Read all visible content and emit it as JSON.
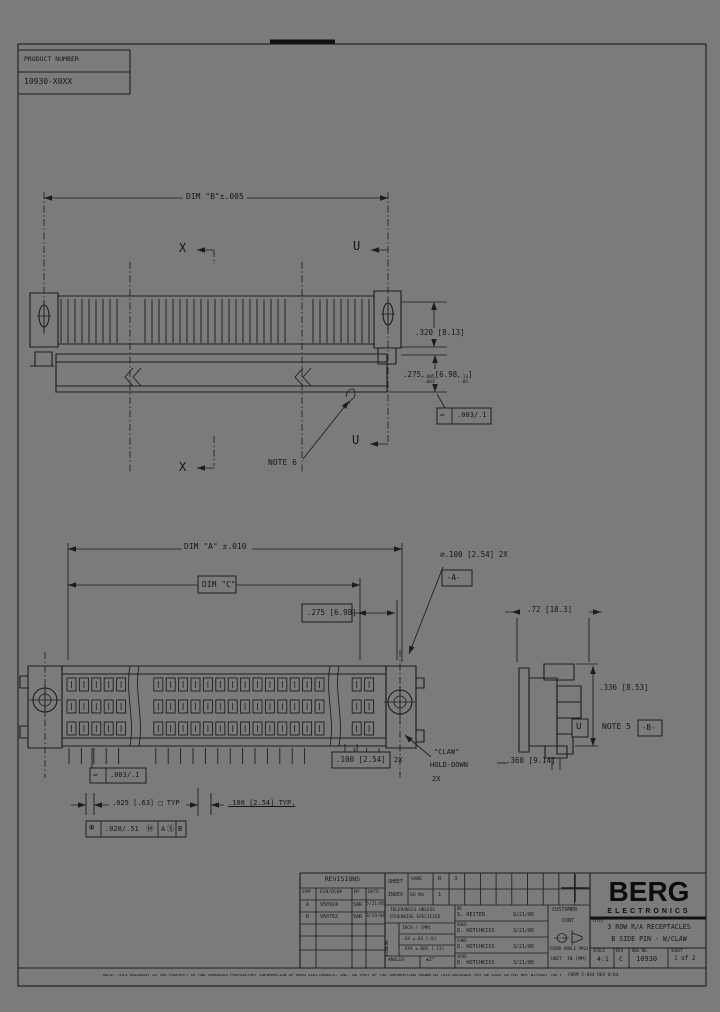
{
  "colors": {
    "bg": "#7b7b7b",
    "ink": "#1c1c1c"
  },
  "product_box": {
    "label": "PRODUCT NUMBER",
    "number": "10930-X0XX"
  },
  "top_view": {
    "dim_b": "DIM \"B\"±.005",
    "section_x_top": "X",
    "section_u_top": "U",
    "section_x_bottom": "X",
    "section_u_bottom": "U",
    "dim_320": ".320 [8.13]",
    "dim_275": {
      "in": ".275",
      "plus": "+.005",
      "minus": "-.003",
      "mm": "[6.98",
      "mm_plus": "+.13",
      "mm_minus": "-.05",
      "close": "]"
    },
    "flatness": {
      "symbol": "▱",
      "value": ".003/.1"
    },
    "note6": "NOTE 6"
  },
  "plan_view": {
    "dim_a": "DIM \"A\" ±.010",
    "dim_c": "DIM \"C\"",
    "dim_275": ".275 [6.98]",
    "hole_callout": "⌀.100 [2.54] 2X",
    "datum_a": "-A-",
    "dim_72": ".72 [18.3]",
    "dim_336": ".336 [8.53]",
    "note5": "NOTE 5",
    "datum_b": "-B-",
    "dim_360": ".360 [9.14]",
    "section_label": "U",
    "dim_100_2x": ".100 [2.54]",
    "dim_100_2x_qty": "2X",
    "claw_line1": "\"CLAW\"",
    "claw_line2": "HOLD-DOWN",
    "claw_line3": "2X",
    "flatness": {
      "symbol": "▱",
      "value": ".003/.1"
    },
    "dim_025": ".025 [.63] □ TYP",
    "dim_100_typ": ".100 [2.54] TYP.",
    "position": {
      "symbol": "⊕",
      "tolerance": ".020/.51",
      "modifier": "Ⓜ",
      "datum1": "A",
      "datum1_mod": "Ⓢ",
      "datum2": "B"
    }
  },
  "title_block": {
    "revisions": {
      "title": "REVISIONS",
      "headers": [
        "SYM",
        "ECN/DCO#",
        "BY",
        "DATE"
      ],
      "rows": [
        [
          "A",
          "V50924",
          "SAR",
          "5/21/85"
        ],
        [
          "B",
          "V60762",
          "SAR",
          "3/19/86"
        ]
      ]
    },
    "sheet_index": {
      "label1": "SHEET",
      "label2": "INDEX",
      "row1_label": "SAME",
      "row2_label": "SH NO",
      "row1_vals": [
        "R",
        "3"
      ],
      "row2_vals": [
        "1",
        ""
      ]
    },
    "tolerances": {
      "title1": "TOLERANCES UNLESS",
      "title2": "OTHERWISE SPECIFIED",
      "linear": "LINEAR",
      "rows": [
        "INCH / [MM]",
        ".XX ±.03 [.8]",
        ".XXX ±.005 [.13]"
      ],
      "angles_label": "ANGLES",
      "angles_value": "±2°"
    },
    "approvals": [
      {
        "label": "DR",
        "name": "S. REITER",
        "date": "9/21/86"
      },
      {
        "label": "ENGR",
        "name": "D. HOTCHKISS",
        "date": "3/21/86"
      },
      {
        "label": "CHKD",
        "name": "D. HOTCHKISS",
        "date": "3/21/86"
      },
      {
        "label": "APVD",
        "name": "D. HOTCHKISS",
        "date": "3/21/86"
      }
    ],
    "customer": {
      "line1": "CUSTOMER",
      "line2": "CONT",
      "projection": "THIRD ANGLE PROJ.",
      "unit_label": "UNIT",
      "unit_value": "IN [MM]"
    },
    "logo": {
      "name": "BERG",
      "sub": "ELECTRONICS"
    },
    "title_label": "TITLE",
    "title1": "3 ROW R/A RECEPTACLES",
    "title2": "B SIDE PIN - W/CLAW",
    "fields": {
      "scale_label": "SCALE",
      "scale": "4:1",
      "rev_label": "REV",
      "rev": "C",
      "dwg_label": "DWG NO.",
      "dwg": "10930",
      "sheet_label": "SHEET",
      "sheet": "1 of 2"
    }
  },
  "footer": {
    "note": "NOTE: THIS DOCUMENT IS THE PROPERTY OF AND EMBODIES PROPRIETARY INFORMATION OF BERG ELECTRONICS, INC.  NO PART OF THE INFORMATION SHOWN ON THIS DOCUMENT MAY BE USED IN ANY WAY WITHOUT THE WRITTEN CONSENT OF BERG ELECTRONICS, INC.",
    "form": "FORM 5-844 REV 8/84"
  }
}
